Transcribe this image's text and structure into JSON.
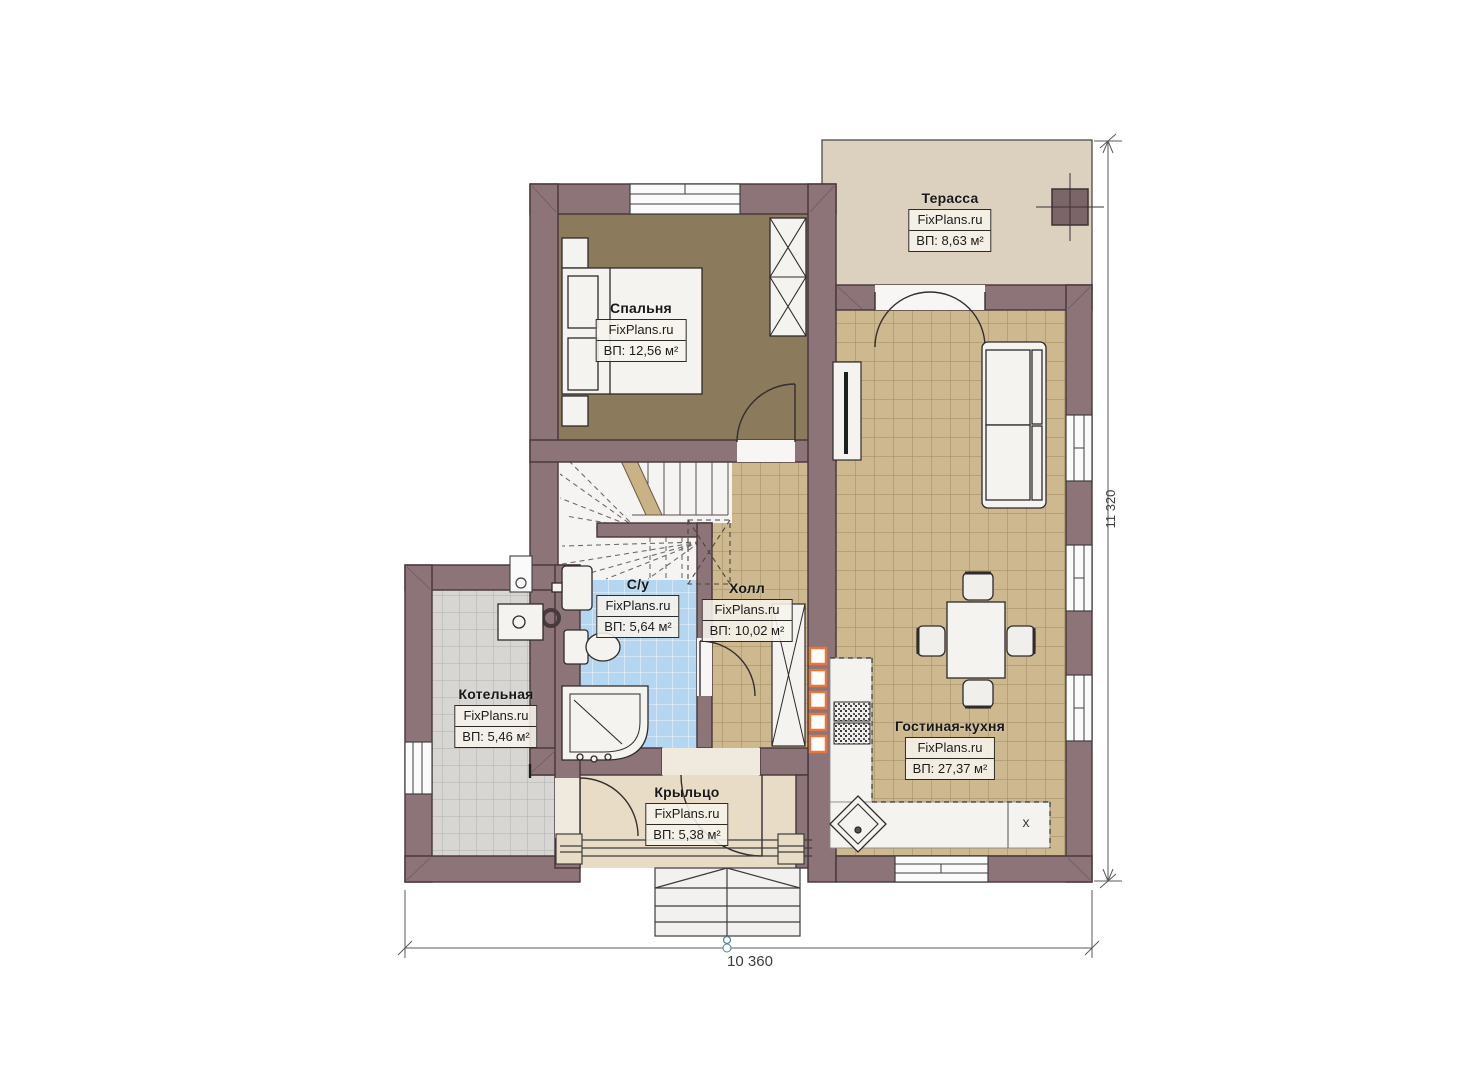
{
  "plan": {
    "watermark": "FixPlans.ru",
    "rooms": {
      "terrace": {
        "name": "Терасса",
        "area": "ВП: 8,63 м²"
      },
      "bedroom": {
        "name": "Спальня",
        "area": "ВП: 12,56 м²"
      },
      "bathroom": {
        "name": "С/у",
        "area": "ВП: 5,64 м²"
      },
      "hall": {
        "name": "Холл",
        "area": "ВП: 10,02 м²"
      },
      "boiler": {
        "name": "Котельная",
        "area": "ВП: 5,46 м²"
      },
      "porch": {
        "name": "Крыльцо",
        "area": "ВП: 5,38 м²"
      },
      "living": {
        "name": "Гостиная-кухня",
        "area": "ВП: 27,37 м²"
      }
    },
    "dimensions": {
      "width_label": "10 360",
      "height_label": "11 320"
    },
    "marks": {
      "kitchen_x": "x"
    },
    "colors": {
      "wall": "#8d7478",
      "accent_orange": "#e8763a",
      "floor_tan": "#cdb88f",
      "floor_blue": "#b5d6f0",
      "floor_gray": "#d8d6d3",
      "floor_bedroom": "#8b7a5c",
      "floor_terrace": "#dcd0bf",
      "floor_porch": "#e9dcc7"
    }
  }
}
